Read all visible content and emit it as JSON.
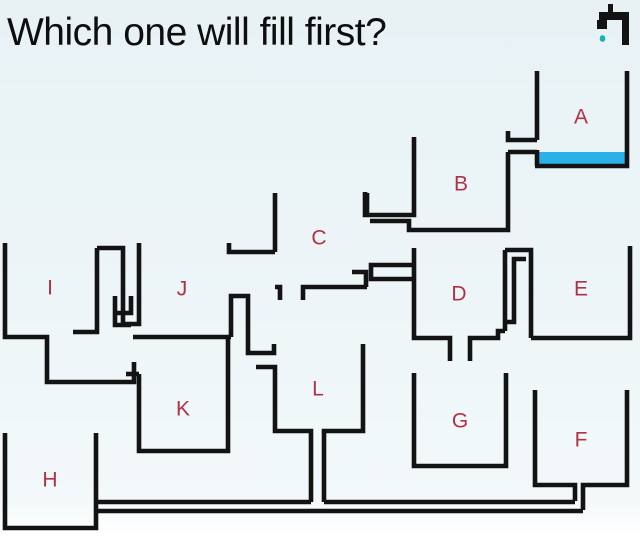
{
  "title": "Which one will fill first?",
  "colors": {
    "line": "#131313",
    "label": "#b03245",
    "water": "#29b1e8",
    "drop": "#16b3b8",
    "title": "#0e0e0e"
  },
  "tap": {
    "name": "faucet-icon",
    "rects": [
      [
        599,
        12,
        30,
        8
      ],
      [
        622,
        12,
        7,
        33
      ],
      [
        597,
        20,
        10,
        9
      ],
      [
        608,
        4,
        5,
        10
      ]
    ],
    "drop": {
      "cx": 602.5,
      "cy": 38.5,
      "rx": 2.8,
      "ry": 3.4
    }
  },
  "water": {
    "x": 539,
    "y": 152,
    "w": 86,
    "h": 13
  },
  "stroke_width": 4.6,
  "labels": [
    {
      "id": "A",
      "x": 581,
      "y": 117
    },
    {
      "id": "B",
      "x": 461,
      "y": 184
    },
    {
      "id": "C",
      "x": 319,
      "y": 238
    },
    {
      "id": "D",
      "x": 459,
      "y": 294
    },
    {
      "id": "E",
      "x": 581,
      "y": 289
    },
    {
      "id": "F",
      "x": 581,
      "y": 440
    },
    {
      "id": "G",
      "x": 460,
      "y": 421
    },
    {
      "id": "H",
      "x": 50,
      "y": 480
    },
    {
      "id": "I",
      "x": 50,
      "y": 288
    },
    {
      "id": "J",
      "x": 182,
      "y": 289
    },
    {
      "id": "K",
      "x": 183,
      "y": 409
    },
    {
      "id": "L",
      "x": 318,
      "y": 389
    }
  ],
  "walls": [
    {
      "name": "tank-a-left-wall-upper",
      "d": "M537,71 L537,140"
    },
    {
      "name": "tank-a-left-wall-lower",
      "d": "M537,150 L537,166"
    },
    {
      "name": "tank-a-floor-and-right-wall",
      "d": "M535,166 L627,166 L627,71"
    },
    {
      "name": "pipe-a-to-b-ceiling",
      "d": "M508,131 L508,140 L537,140"
    },
    {
      "name": "pipe-a-to-b-floor",
      "d": "M508,152 L537,152"
    },
    {
      "name": "tank-b-right-wall-and-floor",
      "d": "M508,152 L508,230 L412,230"
    },
    {
      "name": "tank-b-left-wall-and-outlet-ceiling",
      "d": "M365,192 L365,215 L414,215 L414,137"
    },
    {
      "name": "tank-b-outlet-floor",
      "d": "M370,221 L409,221 L409,230 L412,230"
    },
    {
      "name": "tank-c-left-wall",
      "d": "M275,193 L275,252"
    },
    {
      "name": "tank-c-spout-to-j",
      "d": "M229,243 L229,252 L275,252"
    },
    {
      "name": "tank-c-floor-left-and-drain-stub",
      "d": "M275,287 L280,287 L280,300"
    },
    {
      "name": "tank-c-floor-right-and-drain-stub",
      "d": "M303,300 L303,287 L367,287"
    },
    {
      "name": "tank-c-right-wall-upper-stub",
      "d": "M367,193 L367,213"
    },
    {
      "name": "tank-c-right-wall-lower-and-ledge",
      "d": "M352,272 L366,272 L366,287"
    },
    {
      "name": "pipe-c-to-d",
      "d": "M414,265 L371,265 L371,279 L414,279"
    },
    {
      "name": "tank-d-left-wall-floor-and-slot-stub",
      "d": "M414,248 L414,338 L450,338 L450,361"
    },
    {
      "name": "tank-d-floor-right-and-slot-stub",
      "d": "M470,361 L470,338 L498,338 L498,331 L505,331"
    },
    {
      "name": "tank-d-right-wall",
      "d": "M505,250 L505,331"
    },
    {
      "name": "serpentine-outer-wall-and-tank-e-left-wall",
      "d": "M505,250 L531,250 L531,338"
    },
    {
      "name": "serpentine-inner-wall",
      "d": "M505,322 L514,322 L514,259 L526,259"
    },
    {
      "name": "tank-e-floor-and-right-wall",
      "d": "M531,338 L630,338 L630,246"
    },
    {
      "name": "tank-g-walls",
      "d": "M414,373 L414,466 L506,466 L506,373"
    },
    {
      "name": "tank-f-left-wall-floor-and-riser-left",
      "d": "M535,390 L535,485 L575,485 L575,501"
    },
    {
      "name": "tank-f-riser-right-floor-and-right-wall",
      "d": "M583,510 L583,485 L627,485 L627,390"
    },
    {
      "name": "bottom-pipe-ceiling-left",
      "d": "M98,502 L311,502"
    },
    {
      "name": "bottom-pipe-ceiling-right",
      "d": "M324,502 L575,502"
    },
    {
      "name": "bottom-pipe-floor",
      "d": "M98,511 L583,511"
    },
    {
      "name": "tank-h-walls",
      "d": "M5,433 L5,528 L96,528 L96,433"
    },
    {
      "name": "tank-i-walls-and-under-pipe",
      "d": "M5,243 L5,337 L47,337 L47,382 L134,382 L134,362"
    },
    {
      "name": "chimney-left-wall-and-ledge",
      "d": "M73,332 L97,332 L97,248"
    },
    {
      "name": "chimney-outer-wall-and-tank-j-left-wall",
      "d": "M97,248 L123,248 L123,324 L139,324 L139,243"
    },
    {
      "name": "chimney-inner-baffle-1",
      "d": "M115,296 L115,325 L131,325"
    },
    {
      "name": "chimney-inner-baffle-2",
      "d": "M131,296 L131,313 L115,313"
    },
    {
      "name": "tank-k-inlet-ceiling-stub",
      "d": "M126,374 L139,374"
    },
    {
      "name": "tank-k-walls",
      "d": "M139,374 L139,451 L228,451 L228,337"
    },
    {
      "name": "tank-j-floor",
      "d": "M133,337 L231,337"
    },
    {
      "name": "tank-j-right-wall-and-tube",
      "d": "M231,337 L231,296 L248,296 L248,353 L274,353 L274,344"
    },
    {
      "name": "tank-l-lip-left-wall-floor-and-drain-left",
      "d": "M256,367 L275,367 L275,431 L311,431 L311,502"
    },
    {
      "name": "tank-l-drain-right-floor-and-right-wall",
      "d": "M324,502 L324,431 L363,431 L363,344"
    }
  ]
}
